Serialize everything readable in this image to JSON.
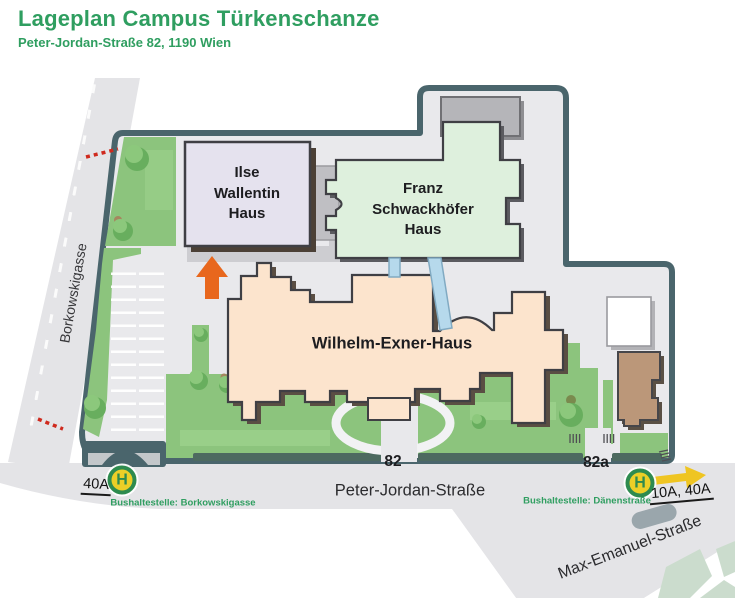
{
  "header": {
    "title": "Lageplan Campus Türkenschanze",
    "subtitle": "Peter-Jordan-Straße 82, 1190 Wien"
  },
  "buildings": {
    "ilse_wallentin": "Ilse Wallentin Haus",
    "franz_schwackhoefer": "Franz Schwackhöfer Haus",
    "wilhelm_exner": "Wilhelm-Exner-Haus"
  },
  "streets": {
    "borkowskigasse": "Borkowskigasse",
    "peter_jordan": "Peter-Jordan-Straße",
    "max_emanuel": "Max-Emanuel-Straße"
  },
  "addresses": {
    "main": "82",
    "annex": "82a"
  },
  "bus_stops": {
    "west": {
      "symbol": "H",
      "lines": "40A",
      "caption": "Bushaltestelle: Borkowskigasse"
    },
    "east": {
      "symbol": "H",
      "lines": "10A, 40A",
      "caption": "Bushaltestelle: Dänenstraße"
    }
  },
  "colors": {
    "accent_green": "#2f9e60",
    "campus_outline": "#4a656c",
    "campus_ground": "#e9e9ec",
    "street_gray": "#e4e4e7",
    "lawn_green": "#8cc47d",
    "ilse_wallentin_fill": "#e5e2ee",
    "franz_schwackhoefer_fill": "#def0dd",
    "wilhelm_exner_fill": "#fce4cd",
    "bus_sign_green": "#2e8b4f",
    "bus_sign_yellow": "#eccf27",
    "entrance_arrow_orange": "#e8671d"
  }
}
